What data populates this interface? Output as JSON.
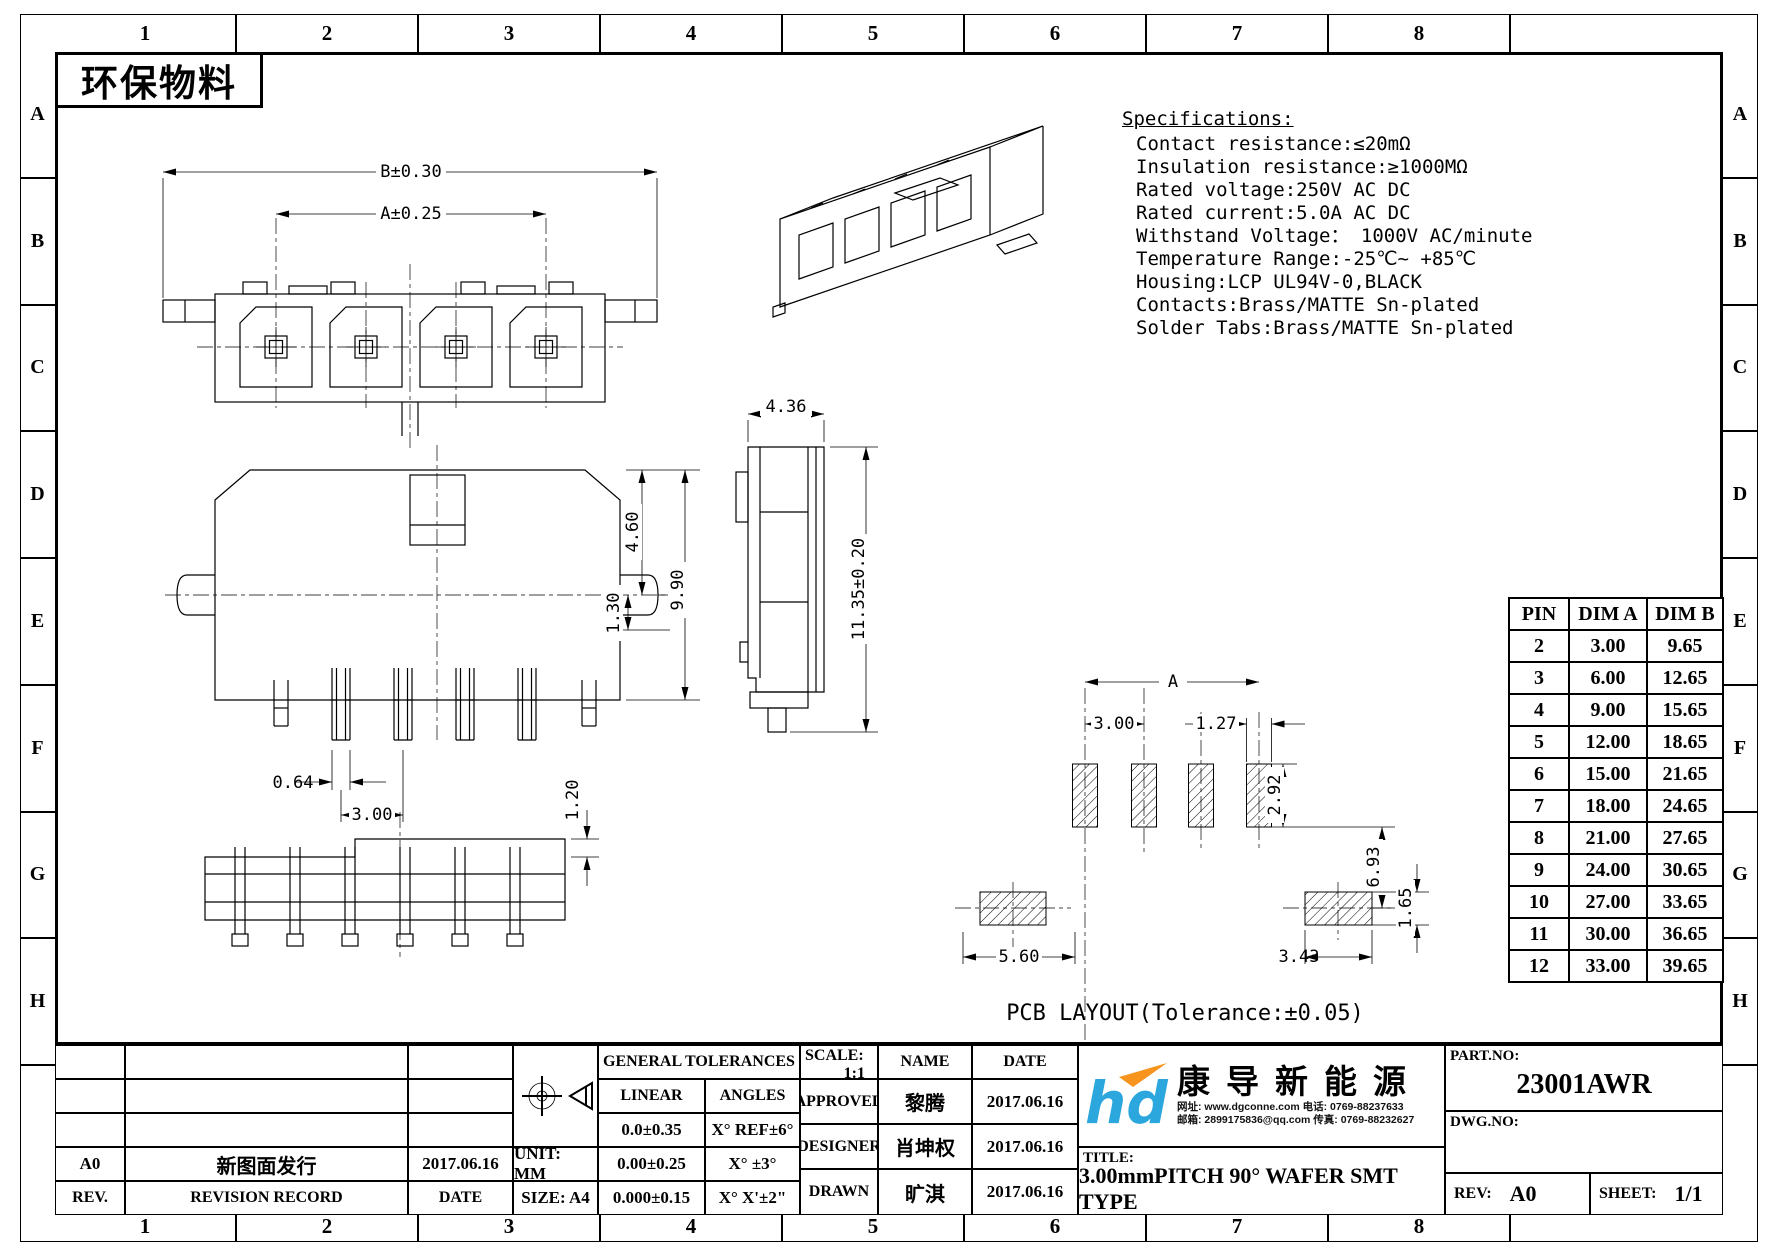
{
  "sheet": {
    "material_label": "环保物料",
    "grid_columns": [
      "1",
      "2",
      "3",
      "4",
      "5",
      "6",
      "7",
      "8"
    ],
    "grid_rows": [
      "A",
      "B",
      "C",
      "D",
      "E",
      "F",
      "G",
      "H"
    ]
  },
  "specifications": {
    "title": "Specifications:",
    "lines": [
      "Contact resistance:≤20mΩ",
      "Insulation resistance:≥1000MΩ",
      "Rated voltage:250V AC DC",
      "Rated current:5.0A AC DC",
      "Withstand Voltage： 1000V AC/minute",
      "Temperature Range:-25℃~ +85℃",
      "Housing:LCP UL94V-0,BLACK",
      "Contacts:Brass/MATTE Sn-plated",
      "Solder Tabs:Brass/MATTE Sn-plated"
    ]
  },
  "views": {
    "front": {
      "dim_overall": "B±0.30",
      "dim_span": "A±0.25"
    },
    "rear": {
      "dim_upper": "4.60",
      "dim_peg": "1.30",
      "dim_height": "9.90",
      "dim_pin_width": "0.64",
      "dim_pitch": "3.00"
    },
    "side": {
      "dim_depth": "4.36",
      "dim_height": "11.35±0.20"
    },
    "bottom": {
      "dim_step": "1.20"
    },
    "pcb": {
      "dim_span": "A",
      "dim_pitch": "3.00",
      "dim_pad_width": "1.27",
      "dim_pad_height": "2.92",
      "dim_gap": "6.93",
      "dim_left_pad": "5.60",
      "dim_right_pad": "3.43",
      "dim_pad_thickness": "1.65",
      "caption": "PCB LAYOUT(Tolerance:±0.05)"
    }
  },
  "pin_table": {
    "headers": [
      "PIN",
      "DIM A",
      "DIM B"
    ],
    "rows": [
      [
        "2",
        "3.00",
        "9.65"
      ],
      [
        "3",
        "6.00",
        "12.65"
      ],
      [
        "4",
        "9.00",
        "15.65"
      ],
      [
        "5",
        "12.00",
        "18.65"
      ],
      [
        "6",
        "15.00",
        "21.65"
      ],
      [
        "7",
        "18.00",
        "24.65"
      ],
      [
        "8",
        "21.00",
        "27.65"
      ],
      [
        "9",
        "24.00",
        "30.65"
      ],
      [
        "10",
        "27.00",
        "33.65"
      ],
      [
        "11",
        "30.00",
        "36.65"
      ],
      [
        "12",
        "33.00",
        "39.65"
      ]
    ]
  },
  "title_block": {
    "revision": {
      "entries": [
        {
          "rev": "A0",
          "record": "新图面发行",
          "date": "2017.06.16"
        }
      ],
      "rev_label": "REV.",
      "record_label": "REVISION RECORD",
      "date_label": "DATE"
    },
    "unit_label": "UNIT: MM",
    "size_label": "SIZE: A4",
    "tolerances": {
      "title": "GENERAL TOLERANCES",
      "linear_label": "LINEAR",
      "angles_label": "ANGLES",
      "rows": [
        [
          "0.0±0.35",
          "X° REF±6°"
        ],
        [
          "0.00±0.25",
          "X° ±3°"
        ],
        [
          "0.000±0.15",
          "X° X'±2\""
        ]
      ]
    },
    "scale_label": "SCALE:",
    "scale_value": "1:1",
    "name_label": "NAME",
    "date_label": "DATE",
    "signoff": [
      {
        "role": "APPROVED",
        "name": "黎腾",
        "date": "2017.06.16"
      },
      {
        "role": "DESIGNER",
        "name": "肖坤权",
        "date": "2017.06.16"
      },
      {
        "role": "DRAWN",
        "name": "旷淇",
        "date": "2017.06.16"
      }
    ],
    "company": {
      "name": "康导新能源",
      "contact1": "网址: www.dgconne.com  电话: 0769-88237633",
      "contact2": "邮箱: 2899175836@qq.com 传真: 0769-88232627"
    },
    "part_label": "PART.NO:",
    "part_value": "23001AWR",
    "dwg_label": "DWG.NO:",
    "title_label": "TITLE:",
    "title_value": "3.00mmPITCH 90° WAFER SMT TYPE",
    "rev_label": "REV:",
    "rev_value": "A0",
    "sheet_label": "SHEET:",
    "sheet_value": "1/1"
  },
  "colors": {
    "logo_blue": "#2BA7DE",
    "logo_orange": "#F7941D",
    "line": "#000000"
  }
}
